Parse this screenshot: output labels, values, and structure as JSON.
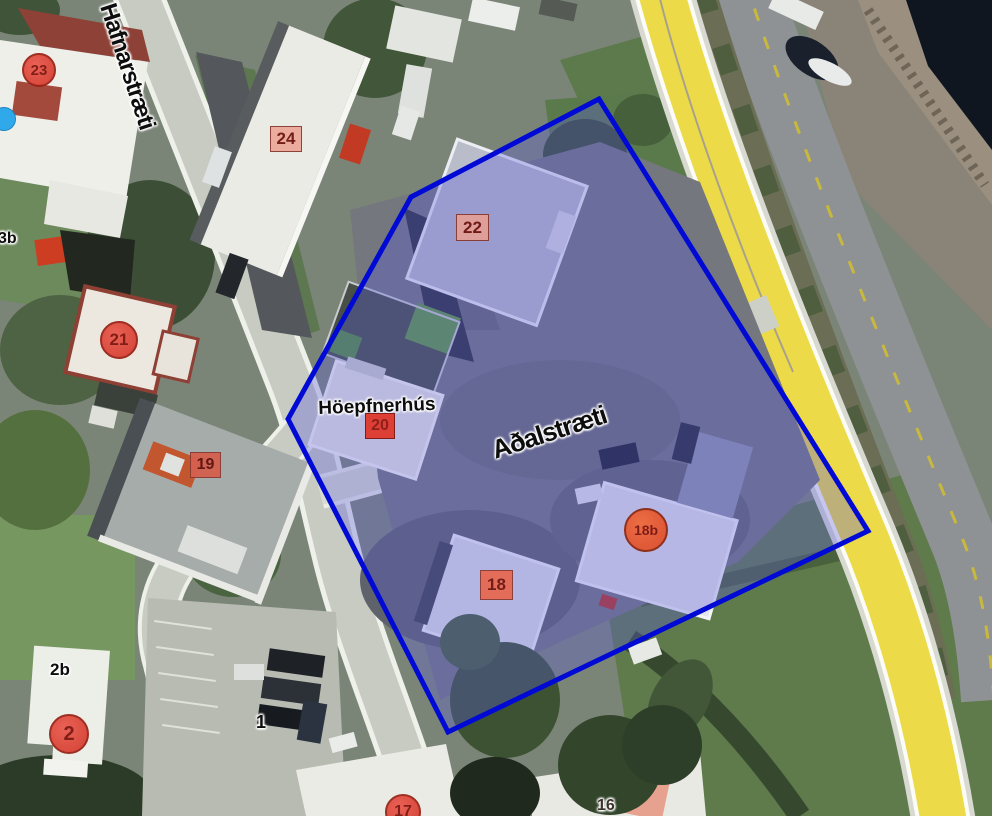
{
  "map": {
    "description": "Aerial satellite map with a blue property-boundary polygon highlighted over the block between Hafnarstræti and Aðalstræti",
    "streets": {
      "hafnarstraeti": "Hafnarstræti",
      "adalstraeti": "Aðalstræti"
    },
    "place": {
      "hoepfnerhus": "Höepfnerhús"
    },
    "overlay": {
      "polygon_points": "599,99 411,197 288,419 448,732 868,531",
      "stroke_color": "#000ad4",
      "fill_color": "rgba(92,92,218,0.33)"
    },
    "markers": {
      "m23": "23",
      "m24": "24",
      "m22": "22",
      "m21": "21",
      "m20": "20",
      "m19": "19",
      "m18": "18",
      "m18b": "18b",
      "m17": "17",
      "m2": "2"
    },
    "labels": {
      "b2b": "2b",
      "b3b": "3b",
      "lot1": "1",
      "b16": "16"
    },
    "colors": {
      "boundary_blue": "#000ad4",
      "road_yellow": "#edda48",
      "marker_red": "#d23a2c",
      "marker_salmon": "#ec9e8e",
      "water_dark": "#10161f",
      "location_dot_blue": "#2fa9e9"
    }
  }
}
